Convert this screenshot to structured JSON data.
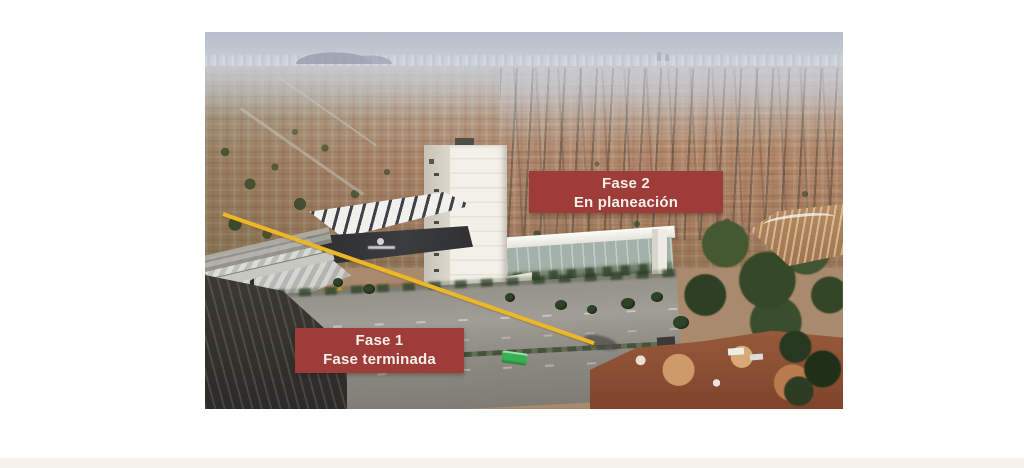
{
  "page": {
    "background_color": "#ffffff",
    "footer_strip_color": "#f5f1ec"
  },
  "annotations": {
    "label_bg_color": "#9e3c39",
    "label_text_color": "#f7f0e8",
    "divider_line_color": "#ecb728",
    "phase2": {
      "line1": "Fase 2",
      "line2": "En planeación"
    },
    "phase1": {
      "line1": "Fase 1",
      "line2": "Fase terminada"
    }
  },
  "photo": {
    "plaza_sign": "PLAZA"
  }
}
